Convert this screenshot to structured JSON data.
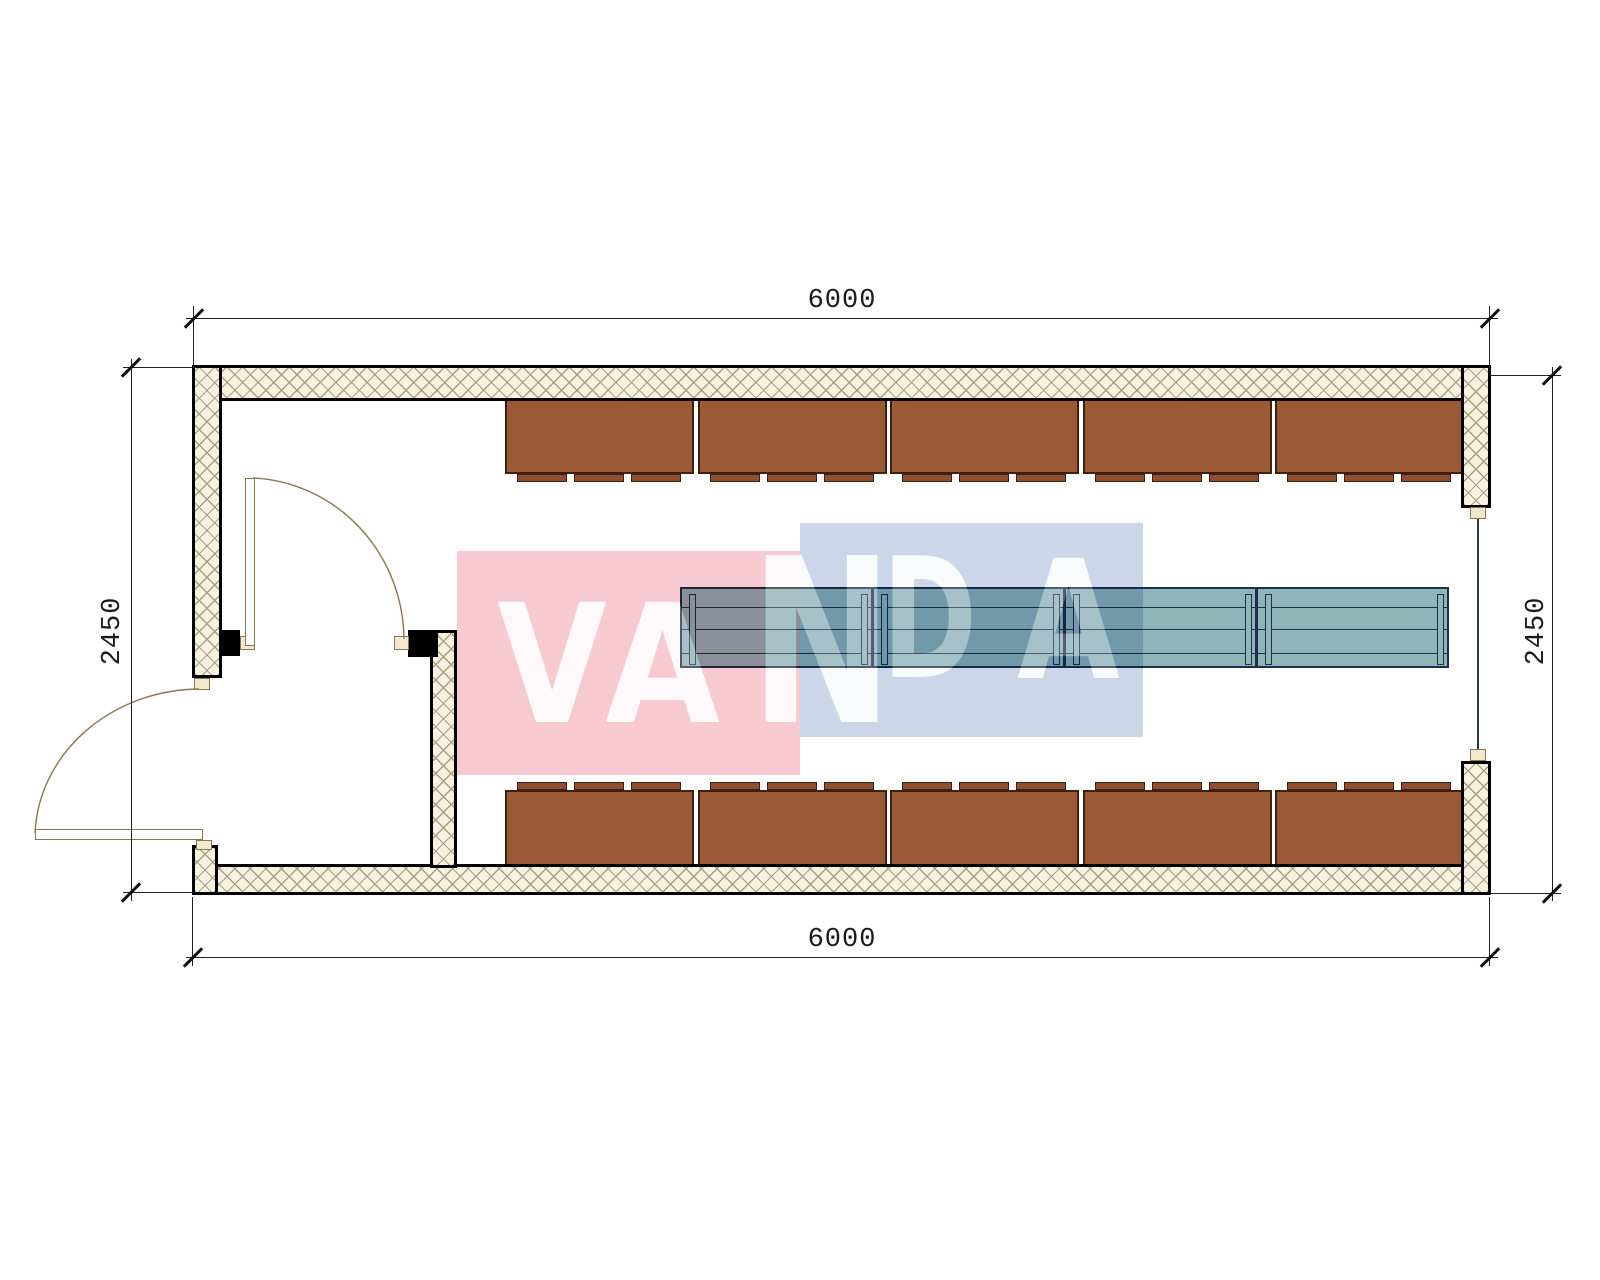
{
  "drawing": {
    "type": "floor-plan",
    "dimensions": {
      "top": "6000",
      "bottom": "6000",
      "left": "2450",
      "right": "2450"
    },
    "watermark": {
      "text": "VANDA",
      "letters": [
        "V",
        "A",
        "N",
        "D",
        "A"
      ],
      "pink_color": "#f7cad1",
      "blue_color": "#cbd7e9",
      "letter_color": "#ffffff"
    },
    "fixtures": {
      "top_cabinet_count": 5,
      "bottom_cabinet_count": 5,
      "table_section_count": 4,
      "cabinet_color": "#9a5a36",
      "table_color": "#8fb5b9",
      "wall_hatch_color": "#f7f1e2"
    }
  }
}
